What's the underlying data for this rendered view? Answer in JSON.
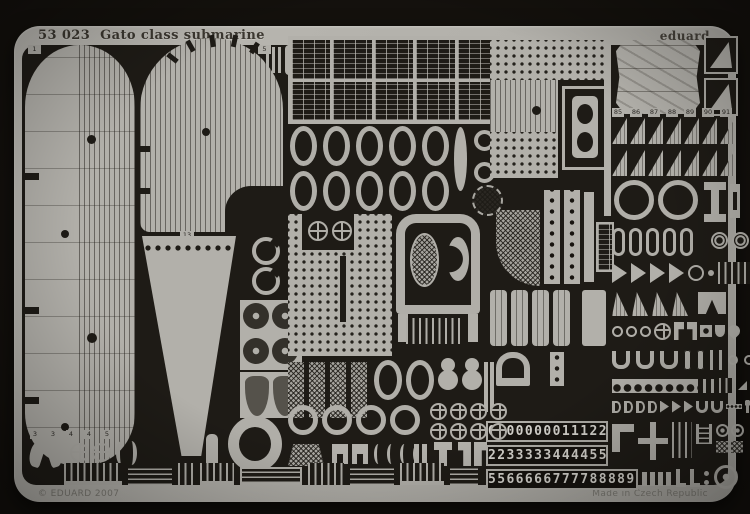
{
  "photo": {
    "subject": "Eduard photo-etched brass detail fret photographed on a dark background",
    "header": {
      "code": "53 023",
      "title": "Gato class submarine",
      "brand": "eduard"
    },
    "footer": {
      "copyright": "© EDUARD 2007",
      "made_in": "Made in Czech Republic"
    },
    "digit_strips": {
      "row1": "0000000011122",
      "row2": "2233333444455",
      "row3": "5566666777788889999",
      "blank_plates_after_row3": 4
    },
    "edge_tabs": [
      {
        "label": "1"
      },
      {
        "label": "5"
      },
      {
        "label": "6"
      },
      {
        "label": "7"
      },
      {
        "label": "23"
      }
    ],
    "wedge_tab": "13",
    "small_part_tabs": [
      {
        "label": "3"
      },
      {
        "label": "3"
      },
      {
        "label": "4"
      },
      {
        "label": "4"
      },
      {
        "label": "5"
      }
    ],
    "gusset_tabs": [
      {
        "label": "85"
      },
      {
        "label": "86"
      },
      {
        "label": "87"
      },
      {
        "label": "88"
      },
      {
        "label": "89"
      },
      {
        "label": "90"
      },
      {
        "label": "91"
      }
    ],
    "colors": {
      "background": "#14110d",
      "metal": "#b2b0aa",
      "etched_dark": "#1e1b16",
      "etched_text": "#3b3730",
      "stamped_text": "#7c7a73"
    }
  }
}
